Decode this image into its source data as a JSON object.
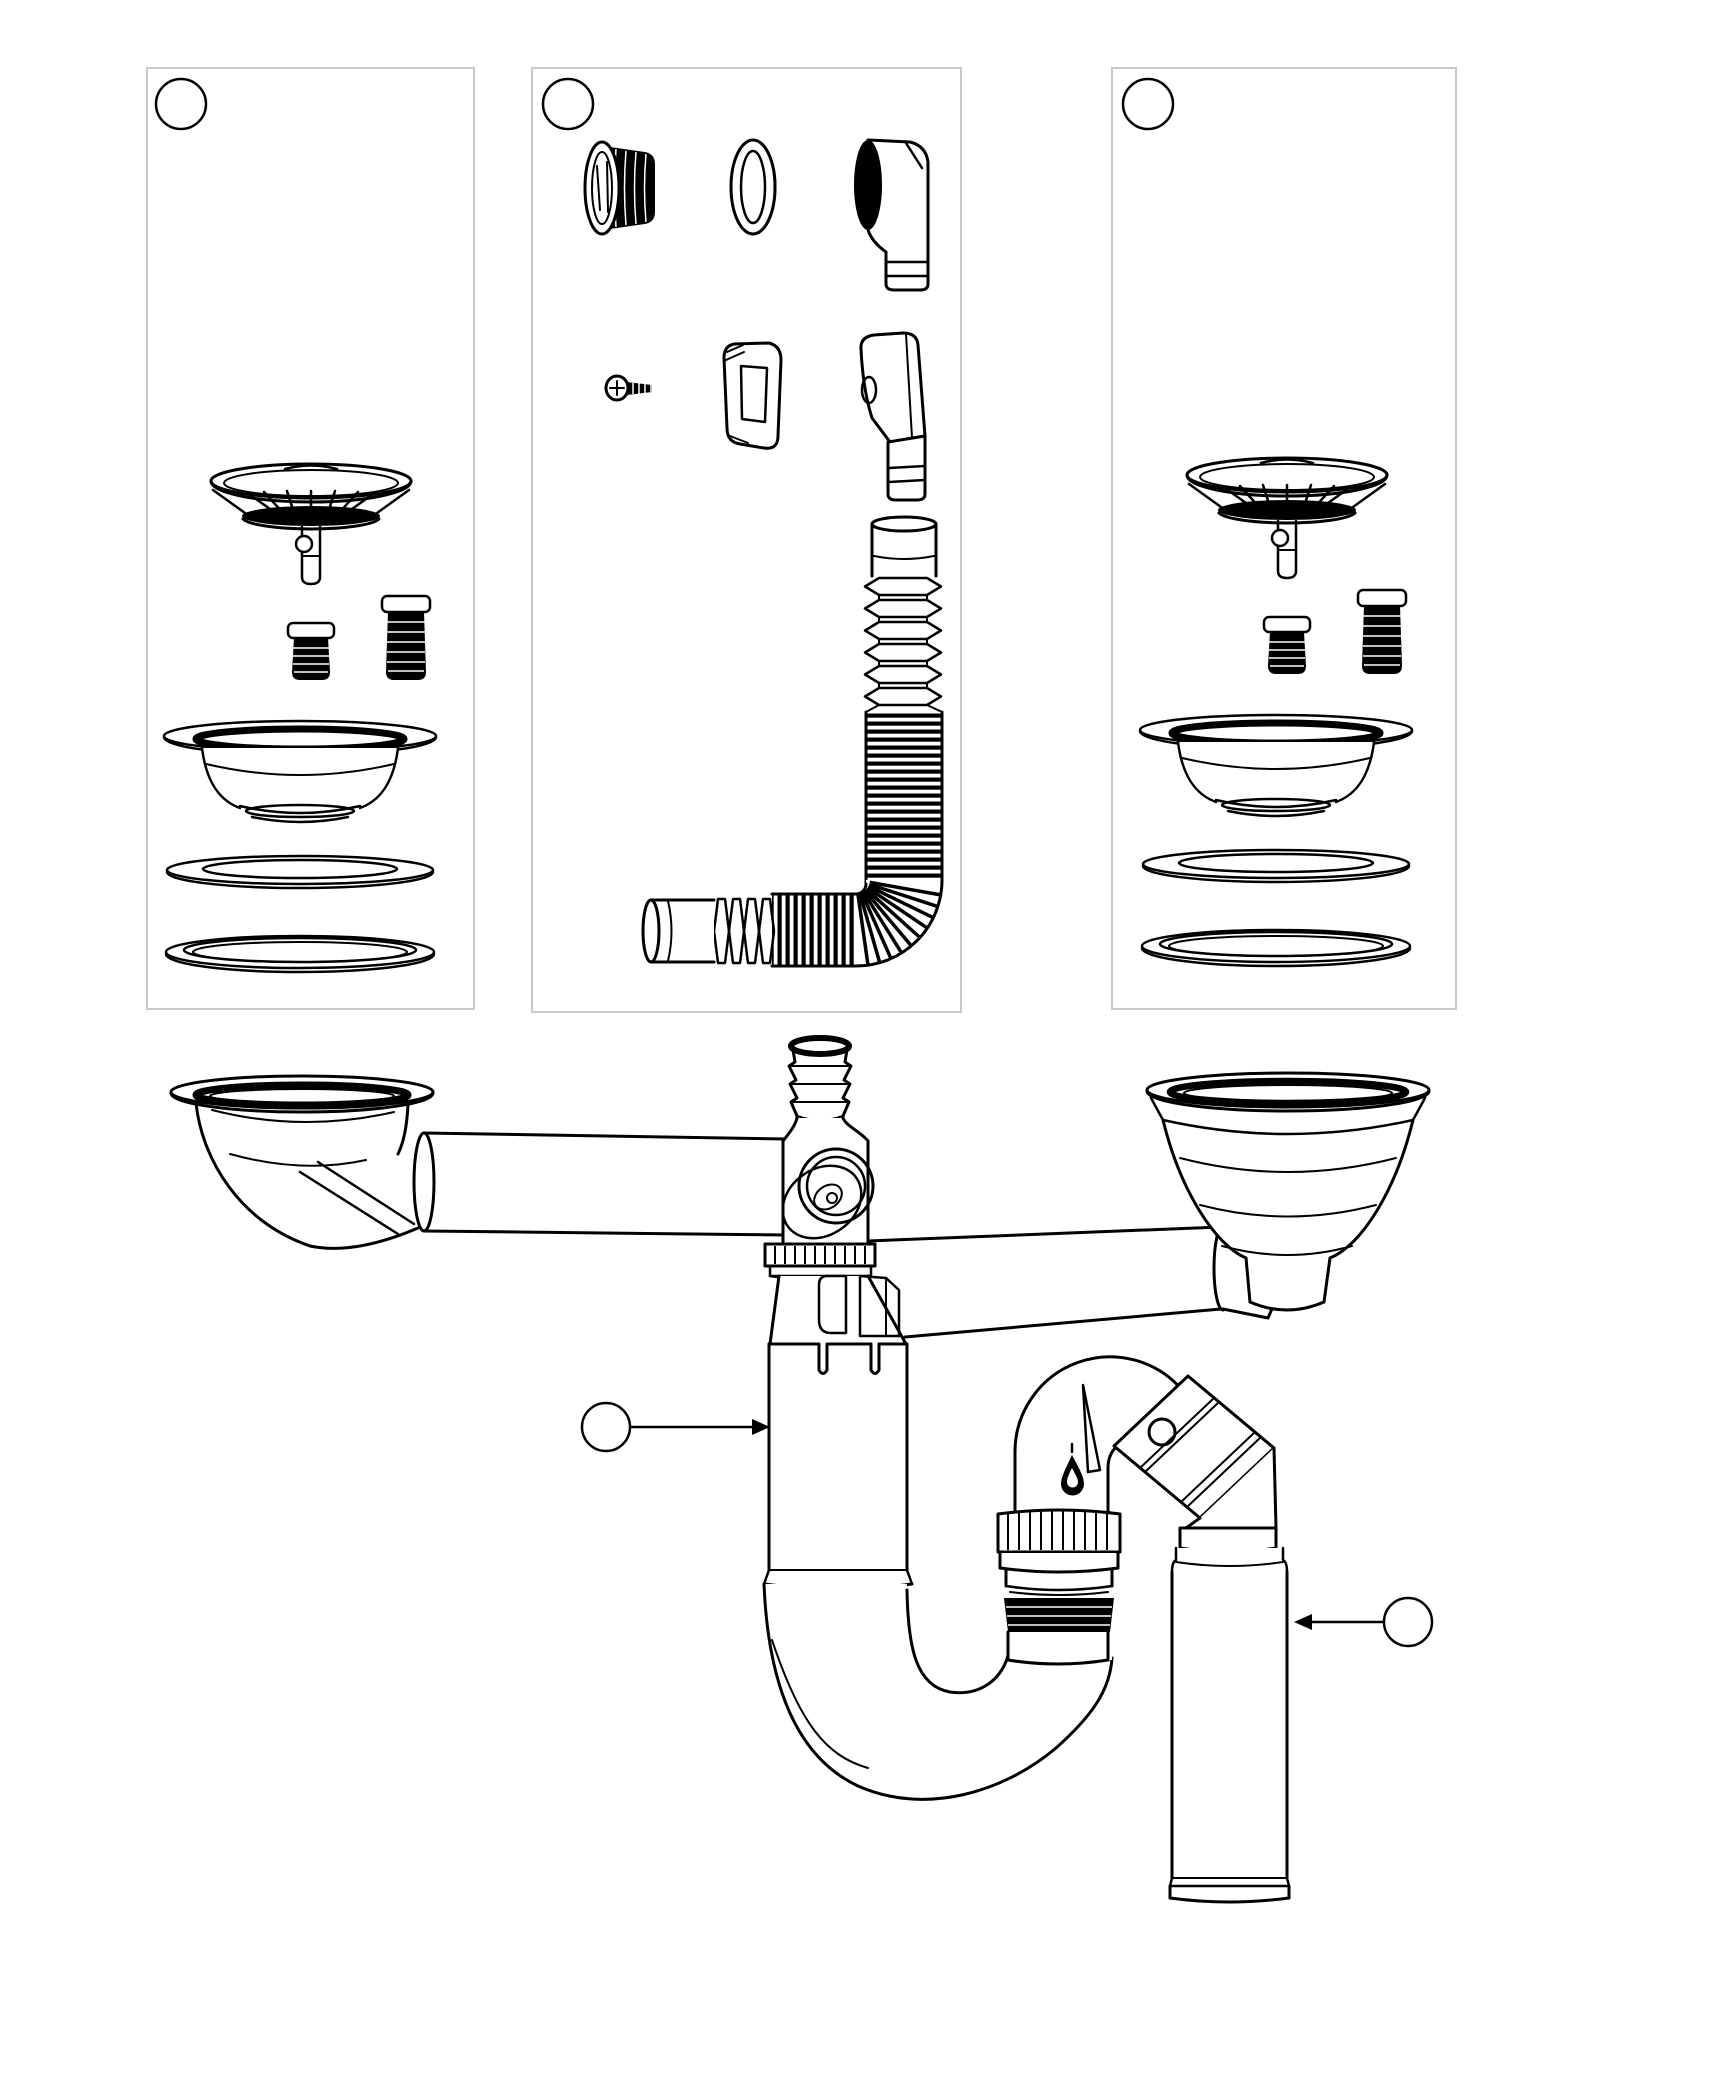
{
  "canvas": {
    "background": "#ffffff",
    "line_color": "#000000",
    "panel_border_color": "#c9c9c9"
  },
  "panels": [
    {
      "label": "3"
    },
    {
      "label": "4"
    },
    {
      "label": "3"
    }
  ],
  "callouts": [
    {
      "label": "2"
    },
    {
      "label": "1"
    }
  ],
  "markings": {
    "trap_mold_mark": "1"
  }
}
